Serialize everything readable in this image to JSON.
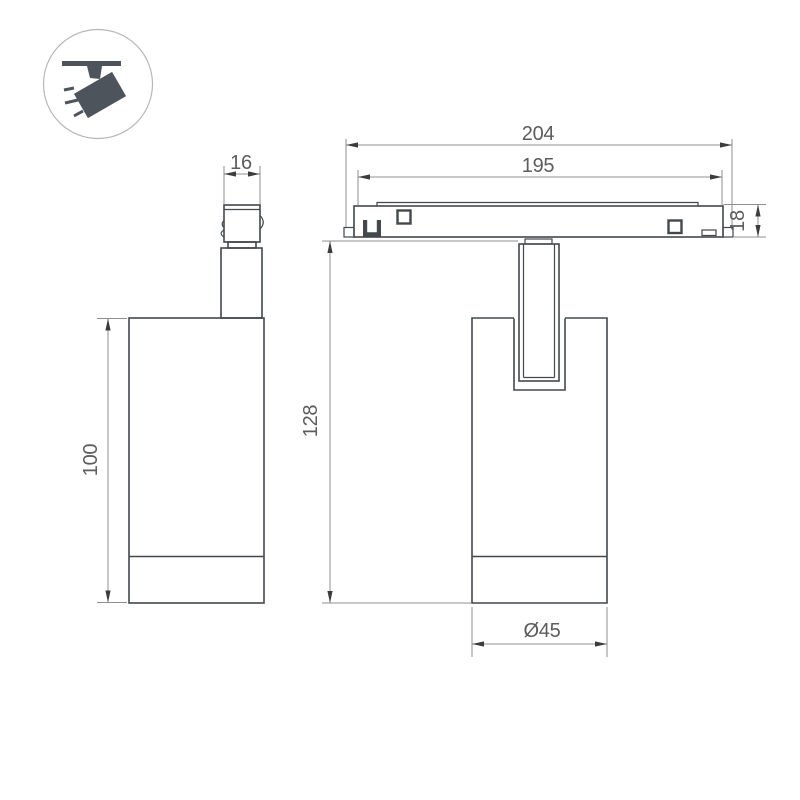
{
  "drawing": {
    "background": "#ffffff",
    "colors": {
      "object_line": "#43484c",
      "dimension_line": "#8f8f8f",
      "dimension_text": "#5c5c5c",
      "arrow": "#3c3c3c",
      "icon_fill": "#4d545b",
      "icon_circle_stroke": "#b4b7ba"
    },
    "icons": {
      "corner_badge": "ceiling-track-spotlight-pictogram"
    },
    "dimensions": {
      "adapter_width": "16",
      "body_height": "100",
      "track_overall_length": "204",
      "track_length": "195",
      "track_height": "18",
      "overall_height": "128",
      "body_diameter": "Ø45"
    }
  }
}
